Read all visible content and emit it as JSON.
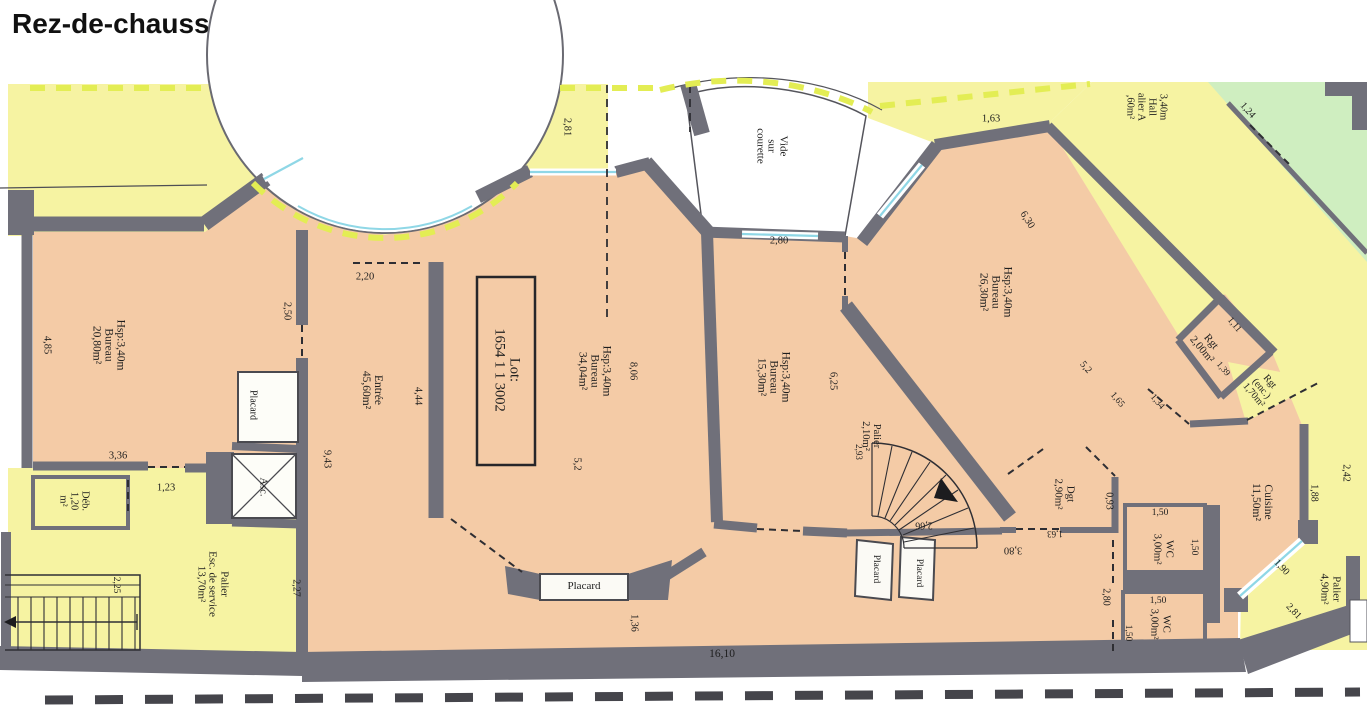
{
  "title": "Rez-de-chaussée",
  "colors": {
    "room_fill": "#f4cba6",
    "common_area_fill": "#f6f3a2",
    "neighbor_fill": "#cfeec0",
    "wall": "#70707a",
    "window": "#8fd7e6",
    "boundary_dash": "#e3ed54",
    "text": "#1e1e1e"
  },
  "plan": {
    "lot_label": "Lot: 1654 1 1 3002",
    "rooms_summary": [
      {
        "name": "Bureau",
        "area": "20,80m²",
        "height": "Hsp:3,40m"
      },
      {
        "name": "Entrée",
        "area": "45,60m²"
      },
      {
        "name": "Bureau",
        "area": "34,04m²",
        "height": "Hsp:3,40m"
      },
      {
        "name": "Bureau",
        "area": "15,30m²",
        "height": "Hsp:3,40m"
      },
      {
        "name": "Bureau",
        "area": "26,30m²",
        "height": "Hsp:3,40m"
      },
      {
        "name": "Cuisine",
        "area": "11,50m²"
      },
      {
        "name": "WC",
        "area": "3,00m²"
      },
      {
        "name": "WC",
        "area": "3,00m²"
      },
      {
        "name": "Dgt",
        "area": "2,90m²"
      },
      {
        "name": "Rgt",
        "area": "2,00m²"
      },
      {
        "name": "Rgt (enc.)",
        "area": "1,70m²"
      },
      {
        "name": "Palier",
        "area": "2,10m²"
      },
      {
        "name": "Palier",
        "area": "4,90m²"
      },
      {
        "name": "Palier Esc. de service",
        "area": "13,70m²"
      },
      {
        "name": "Déb.",
        "area": "1,20 m²"
      },
      {
        "name": "Vide sur courette"
      }
    ],
    "labels": [
      {
        "id": "room-bureau-20",
        "lines": [
          "Hsp:3,40m",
          "Bureau",
          "20,80m²"
        ],
        "x": 108,
        "y": 345,
        "rot": 90,
        "size": 11.5
      },
      {
        "id": "dim-4-85",
        "lines": [
          "4,85"
        ],
        "x": 47,
        "y": 345,
        "rot": 90,
        "size": 10.5
      },
      {
        "id": "dim-3-36",
        "lines": [
          "3,36"
        ],
        "x": 118,
        "y": 456,
        "rot": 0,
        "size": 10.5
      },
      {
        "id": "dim-2-50",
        "lines": [
          "2,50"
        ],
        "x": 287,
        "y": 311,
        "rot": 90,
        "size": 10.5
      },
      {
        "id": "dim-1-23",
        "lines": [
          "1,23"
        ],
        "x": 166,
        "y": 488,
        "rot": 0,
        "size": 10.5
      },
      {
        "id": "room-deb",
        "lines": [
          "Déb.",
          "1,20",
          "m²"
        ],
        "x": 74,
        "y": 501,
        "rot": 90,
        "size": 10.5
      },
      {
        "id": "dim-2-81-top",
        "lines": [
          "2,81"
        ],
        "x": 567,
        "y": 127,
        "rot": 90,
        "size": 10.5
      },
      {
        "id": "room-entree",
        "lines": [
          "Entrée",
          "45,60m²"
        ],
        "x": 372,
        "y": 390,
        "rot": 90,
        "size": 11.5
      },
      {
        "id": "dim-2-20",
        "lines": [
          "2,20"
        ],
        "x": 365,
        "y": 277,
        "rot": 0,
        "size": 10.5
      },
      {
        "id": "dim-4-44",
        "lines": [
          "4,44"
        ],
        "x": 418,
        "y": 396,
        "rot": 90,
        "size": 10.5
      },
      {
        "id": "dim-9-43",
        "lines": [
          "9,43"
        ],
        "x": 327,
        "y": 459,
        "rot": 90,
        "size": 10.5
      },
      {
        "id": "closet-placard-left",
        "lines": [
          "Placard"
        ],
        "x": 252,
        "y": 405,
        "rot": 90,
        "size": 10
      },
      {
        "id": "elevator-asc",
        "lines": [
          "Asc."
        ],
        "x": 263,
        "y": 487,
        "rot": 90,
        "size": 10.5
      },
      {
        "id": "room-palier-service",
        "lines": [
          "Palier",
          "Esc. de service",
          "13,70m²"
        ],
        "x": 212,
        "y": 584,
        "rot": 90,
        "size": 11
      },
      {
        "id": "dim-2-25",
        "lines": [
          "2,25"
        ],
        "x": 116,
        "y": 585,
        "rot": 90,
        "size": 9.5
      },
      {
        "id": "dim-2-27",
        "lines": [
          "2,27"
        ],
        "x": 295,
        "y": 588,
        "rot": 90,
        "size": 10
      },
      {
        "id": "lot-number",
        "lines": [
          "Lot:",
          "1654 1 1 3002"
        ],
        "x": 506,
        "y": 370,
        "rot": 90,
        "size": 14.5
      },
      {
        "id": "room-bureau-34",
        "lines": [
          "Hsp:3,40m",
          "Bureau",
          "34,04m²"
        ],
        "x": 594,
        "y": 371,
        "rot": 90,
        "size": 11.5
      },
      {
        "id": "dim-8-06",
        "lines": [
          "8,06"
        ],
        "x": 633,
        "y": 371,
        "rot": 90,
        "size": 10.5
      },
      {
        "id": "dim-5-2-a",
        "lines": [
          "5,2"
        ],
        "x": 577,
        "y": 464,
        "rot": 90,
        "size": 10.5
      },
      {
        "id": "room-bureau-15",
        "lines": [
          "Hsp:3,40m",
          "Bureau",
          "15,30m²"
        ],
        "x": 773,
        "y": 377,
        "rot": 90,
        "size": 11.5
      },
      {
        "id": "dim-6-25",
        "lines": [
          "6,25"
        ],
        "x": 833,
        "y": 381,
        "rot": 90,
        "size": 10.5
      },
      {
        "id": "void-courette",
        "lines": [
          "Vide",
          "sur",
          "courette"
        ],
        "x": 771,
        "y": 146,
        "rot": 90,
        "size": 11
      },
      {
        "id": "dim-2-80-courette",
        "lines": [
          "2,80"
        ],
        "x": 779,
        "y": 241,
        "rot": 0,
        "size": 10.5
      },
      {
        "id": "room-bureau-26",
        "lines": [
          "Hsp:3,40m",
          "Bureau",
          "26,30m²"
        ],
        "x": 995,
        "y": 292,
        "rot": 90,
        "size": 11.5
      },
      {
        "id": "dim-6-30",
        "lines": [
          "6,30"
        ],
        "x": 1027,
        "y": 220,
        "rot": 58,
        "size": 10.5
      },
      {
        "id": "dim-1-63-top",
        "lines": [
          "1,63"
        ],
        "x": 991,
        "y": 119,
        "rot": 0,
        "size": 10.5
      },
      {
        "id": "hall-palier-a",
        "lines": [
          "3,40m",
          "Hall",
          "alier A",
          ",60m²"
        ],
        "x": 1146,
        "y": 107,
        "rot": 90,
        "size": 10.5
      },
      {
        "id": "dim-1-24",
        "lines": [
          "1,24"
        ],
        "x": 1247,
        "y": 111,
        "rot": 48,
        "size": 10
      },
      {
        "id": "room-rgt",
        "lines": [
          "Rgt",
          "2,00m²"
        ],
        "x": 1206,
        "y": 346,
        "rot": 50,
        "size": 11
      },
      {
        "id": "dim-1-11",
        "lines": [
          "1,11"
        ],
        "x": 1234,
        "y": 325,
        "rot": 50,
        "size": 9.5
      },
      {
        "id": "dim-1-39",
        "lines": [
          "1,39"
        ],
        "x": 1223,
        "y": 369,
        "rot": 50,
        "size": 9
      },
      {
        "id": "dim-5-2-b",
        "lines": [
          "5,2"
        ],
        "x": 1085,
        "y": 368,
        "rot": 50,
        "size": 10
      },
      {
        "id": "dim-1-65",
        "lines": [
          "1,65"
        ],
        "x": 1117,
        "y": 400,
        "rot": 50,
        "size": 9.5
      },
      {
        "id": "dim-1-34",
        "lines": [
          "1,34"
        ],
        "x": 1157,
        "y": 402,
        "rot": 50,
        "size": 9.5
      },
      {
        "id": "room-rgt-enc",
        "lines": [
          "Rgt",
          "(enc.)",
          "1,70m²"
        ],
        "x": 1261,
        "y": 389,
        "rot": 50,
        "size": 10
      },
      {
        "id": "room-cuisine",
        "lines": [
          "Cuisine",
          "11,50m²"
        ],
        "x": 1262,
        "y": 502,
        "rot": 90,
        "size": 11.5
      },
      {
        "id": "dim-1-88",
        "lines": [
          "1,88"
        ],
        "x": 1313,
        "y": 493,
        "rot": 90,
        "size": 10
      },
      {
        "id": "dim-2-42",
        "lines": [
          "2,42"
        ],
        "x": 1345,
        "y": 473,
        "rot": 90,
        "size": 10
      },
      {
        "id": "dim-1-90",
        "lines": [
          "1,90"
        ],
        "x": 1281,
        "y": 568,
        "rot": 47,
        "size": 10
      },
      {
        "id": "dim-2-81-br",
        "lines": [
          "2,81"
        ],
        "x": 1293,
        "y": 612,
        "rot": 47,
        "size": 10
      },
      {
        "id": "room-palier-49",
        "lines": [
          "Palier",
          "4,90m²"
        ],
        "x": 1330,
        "y": 589,
        "rot": 90,
        "size": 11
      },
      {
        "id": "room-dgt",
        "lines": [
          "Dgt",
          "2,90m²"
        ],
        "x": 1064,
        "y": 494,
        "rot": 90,
        "size": 11
      },
      {
        "id": "dim-0-93",
        "lines": [
          "0,93"
        ],
        "x": 1108,
        "y": 501,
        "rot": 90,
        "size": 10
      },
      {
        "id": "dim-1-63-small",
        "lines": [
          "1,63"
        ],
        "x": 1055,
        "y": 533,
        "rot": 180,
        "size": 9
      },
      {
        "id": "dim-3-80",
        "lines": [
          "3,80"
        ],
        "x": 1013,
        "y": 550,
        "rot": 180,
        "size": 10.5
      },
      {
        "id": "dim-2-66",
        "lines": [
          "2,66"
        ],
        "x": 924,
        "y": 524,
        "rot": 180,
        "size": 10
      },
      {
        "id": "room-palier-210",
        "lines": [
          "Palier",
          "2,10m²"
        ],
        "x": 871,
        "y": 436,
        "rot": 90,
        "size": 10.5
      },
      {
        "id": "dim-2-93",
        "lines": [
          "2,93"
        ],
        "x": 858,
        "y": 452,
        "rot": 90,
        "size": 9
      },
      {
        "id": "closet-placard-mid-1",
        "lines": [
          "Placard"
        ],
        "x": 876,
        "y": 569,
        "rot": 90,
        "size": 9.5
      },
      {
        "id": "closet-placard-mid-2",
        "lines": [
          "Placard"
        ],
        "x": 919,
        "y": 573,
        "rot": 90,
        "size": 9.5
      },
      {
        "id": "closet-placard-bottom",
        "lines": [
          "Placard"
        ],
        "x": 584,
        "y": 587,
        "rot": 0,
        "size": 11
      },
      {
        "id": "dim-1-36",
        "lines": [
          "1,36"
        ],
        "x": 633,
        "y": 623,
        "rot": 90,
        "size": 10
      },
      {
        "id": "dim-16-10",
        "lines": [
          "16,10"
        ],
        "x": 722,
        "y": 654,
        "rot": 0,
        "size": 11.5
      },
      {
        "id": "room-wc-upper",
        "lines": [
          "WC",
          "3,00m²"
        ],
        "x": 1163,
        "y": 549,
        "rot": 90,
        "size": 11
      },
      {
        "id": "dim-1-50-a",
        "lines": [
          "1,50"
        ],
        "x": 1160,
        "y": 513,
        "rot": 0,
        "size": 9.5
      },
      {
        "id": "dim-1-50-b",
        "lines": [
          "1,50"
        ],
        "x": 1194,
        "y": 547,
        "rot": 90,
        "size": 9.5
      },
      {
        "id": "room-wc-lower",
        "lines": [
          "WC",
          "3,00m²"
        ],
        "x": 1160,
        "y": 624,
        "rot": 90,
        "size": 11
      },
      {
        "id": "dim-1-50-c",
        "lines": [
          "1,50"
        ],
        "x": 1158,
        "y": 601,
        "rot": 0,
        "size": 9.5
      },
      {
        "id": "dim-1-50-d",
        "lines": [
          "1,50"
        ],
        "x": 1128,
        "y": 633,
        "rot": 90,
        "size": 9.5
      },
      {
        "id": "dim-2-80-right",
        "lines": [
          "2,80"
        ],
        "x": 1105,
        "y": 597,
        "rot": 90,
        "size": 10
      }
    ]
  }
}
